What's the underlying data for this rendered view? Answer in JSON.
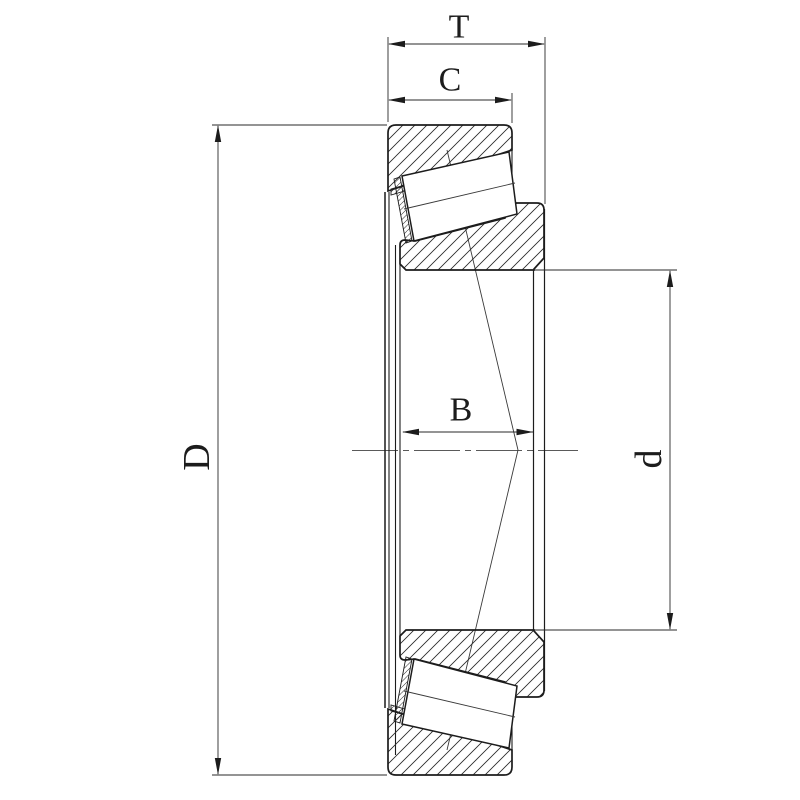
{
  "drawing": {
    "title": "tapered-roller-bearing-cross-section",
    "labels": {
      "total_width": "T",
      "cup_width": "C",
      "cone_width": "B",
      "outer_diameter": "D",
      "bore_diameter": "d"
    },
    "colors": {
      "line": "#1c1c1c",
      "dimension": "#2a2a2a",
      "centerline": "#5a5a5a",
      "background": "#ffffff"
    }
  }
}
